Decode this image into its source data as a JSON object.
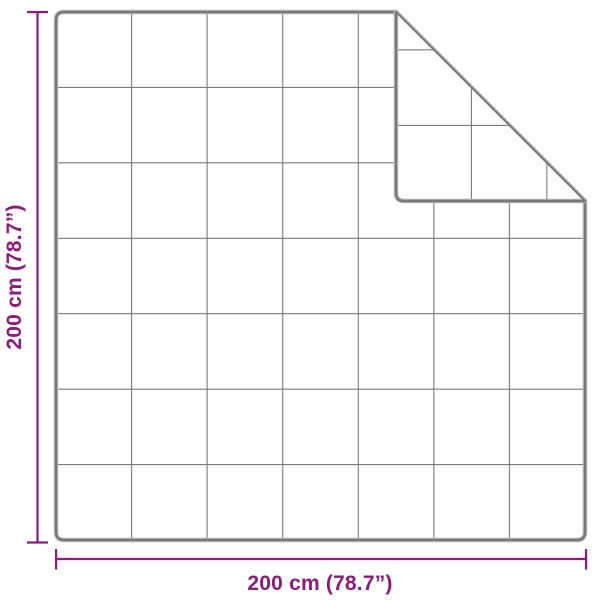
{
  "colors": {
    "accent": "#8E1A7E",
    "outline_dark": "#787878",
    "outline_light": "#B2B2B2",
    "grid": "#7C7C7C",
    "background": "#FFFFFF"
  },
  "blanket": {
    "rows": 7,
    "cols": 7
  },
  "dimensions": {
    "width_label": "200 cm (78.7”)",
    "height_label": "200 cm (78.7”)"
  }
}
